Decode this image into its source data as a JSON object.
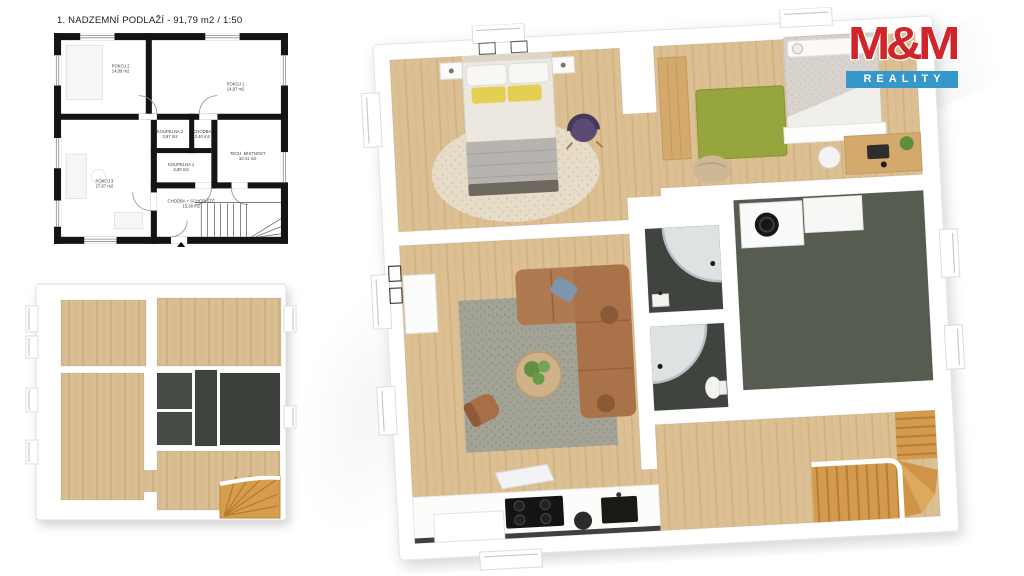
{
  "header": {
    "title": "1. NADZEMNÍ PODLAŽÍ -  91,79 m2 / 1:50"
  },
  "logo": {
    "mm": "M&M",
    "reality": "REALITY"
  },
  "plan2d": {
    "rooms": [
      {
        "label": "POKOJ 2",
        "area": "14,09 m2"
      },
      {
        "label": "POKOJ 1",
        "area": "14,97 m2"
      },
      {
        "label": "KOUPELNA 2",
        "area": "3,97 m2"
      },
      {
        "label": "CHODBA",
        "area": "2,40 m2"
      },
      {
        "label": "TECH. MÍSTNOST",
        "area": "10,41 m2"
      },
      {
        "label": "KOUPELNA 1",
        "area": "2,90 m2"
      },
      {
        "label": "POKOJ 3",
        "area": "27,67 m2"
      },
      {
        "label": "CHODBA + SCHODIŠTĚ",
        "area": "15,38 m2"
      }
    ]
  },
  "colors": {
    "logo_red": "#d0262b",
    "logo_blue": "#3697cb",
    "plan_line_black": "#141414",
    "wall_white": "#ffffff",
    "wood_floor": "#dcc094",
    "wood_floor_small": "#d9bd93",
    "dark_floor_bath": "#3f443f",
    "dark_floor_tech": "#575c50",
    "stair_wood": "#d49a4e",
    "sofa_brown": "#b07a50",
    "rug_gray": "#a3a296",
    "rug_green": "#97a53e",
    "pillow_yellow": "#e4cf52",
    "chair_purple": "#5b4a74"
  }
}
